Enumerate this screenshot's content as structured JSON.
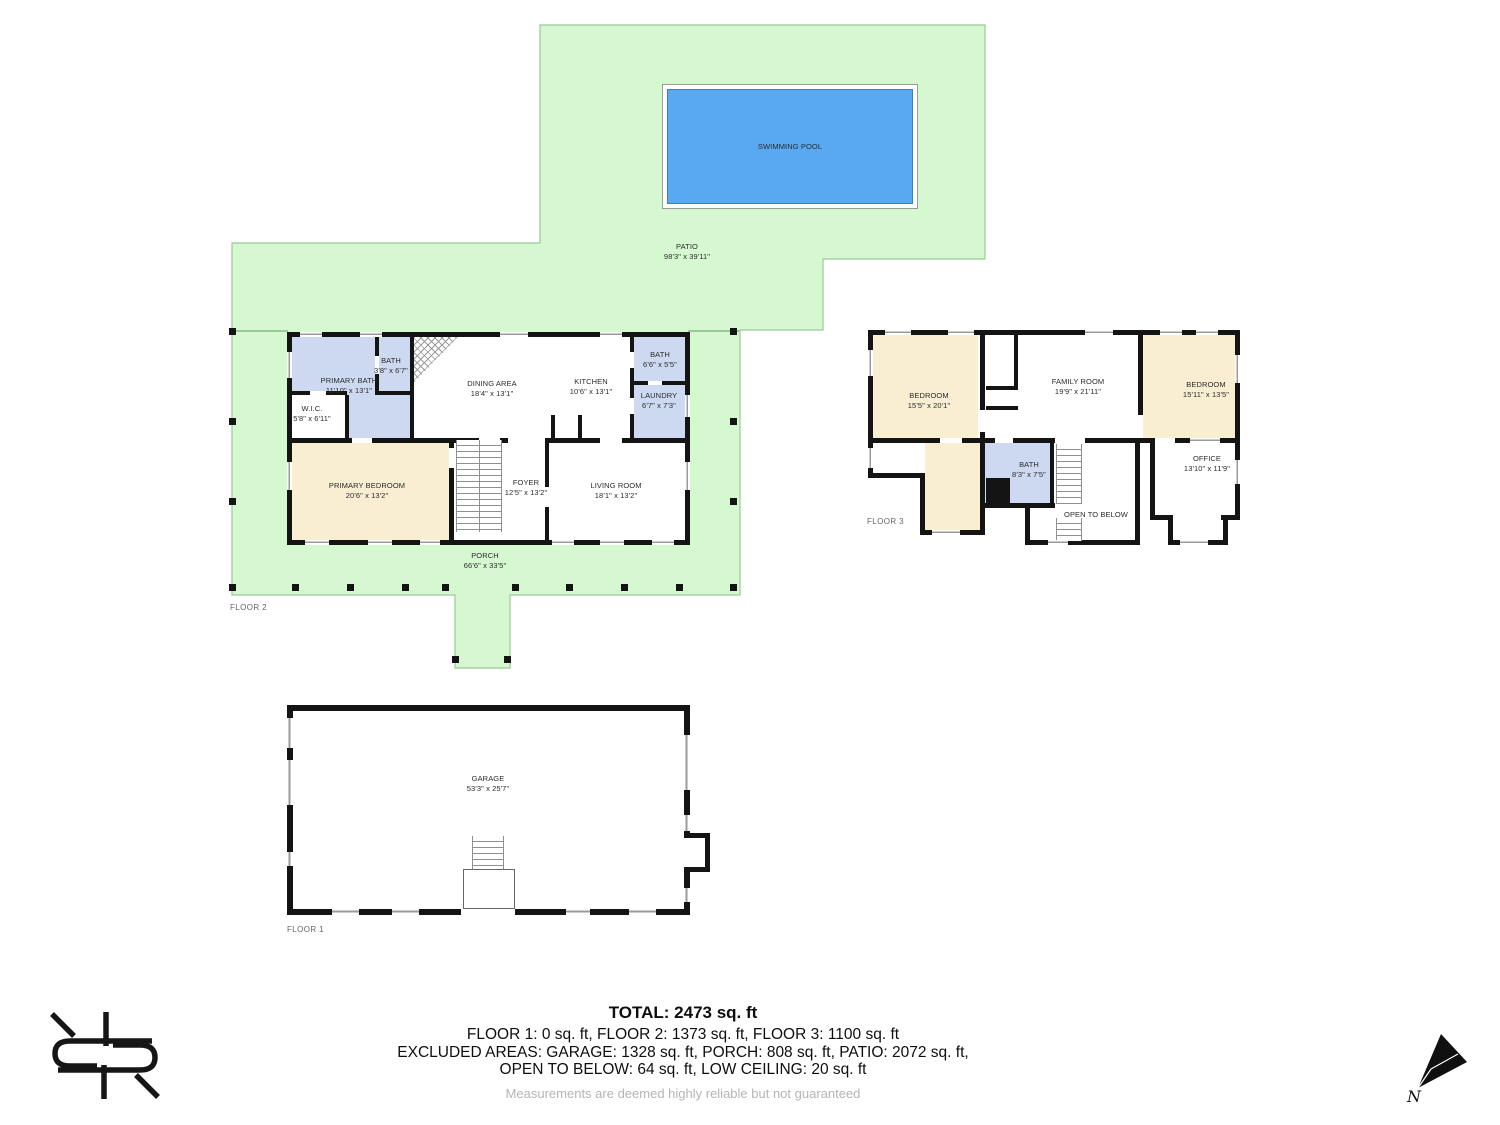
{
  "site": {
    "patio": {
      "name": "PATIO",
      "dims": "98'3\" x 39'11\""
    },
    "pool": {
      "name": "SWIMMING POOL"
    }
  },
  "floor2": {
    "label": "FLOOR 2",
    "rooms": {
      "primary_bath": {
        "name": "PRIMARY BATH",
        "dims": "11'10\" x 13'1\""
      },
      "bath_small": {
        "name": "BATH",
        "dims": "3'8\" x 6'7\""
      },
      "wic": {
        "name": "W.I.C.",
        "dims": "5'8\" x 6'11\""
      },
      "dining": {
        "name": "DINING AREA",
        "dims": "18'4\" x 13'1\""
      },
      "kitchen": {
        "name": "KITCHEN",
        "dims": "10'6\" x 13'1\""
      },
      "bath": {
        "name": "BATH",
        "dims": "6'6\" x 5'5\""
      },
      "laundry": {
        "name": "LAUNDRY",
        "dims": "6'7\" x 7'3\""
      },
      "primary_bedroom": {
        "name": "PRIMARY BEDROOM",
        "dims": "20'6\" x 13'2\""
      },
      "foyer": {
        "name": "FOYER",
        "dims": "12'5\" x 13'2\""
      },
      "living_room": {
        "name": "LIVING ROOM",
        "dims": "18'1\" x 13'2\""
      },
      "porch": {
        "name": "PORCH",
        "dims": "66'6\" x 33'5\""
      }
    }
  },
  "floor3": {
    "label": "FLOOR 3",
    "rooms": {
      "bedroom_left": {
        "name": "BEDROOM",
        "dims": "15'5\" x 20'1\""
      },
      "family_room": {
        "name": "FAMILY ROOM",
        "dims": "19'9\" x 21'11\""
      },
      "bedroom_right": {
        "name": "BEDROOM",
        "dims": "15'11\" x 13'5\""
      },
      "bath": {
        "name": "BATH",
        "dims": "8'3\" x 7'5\""
      },
      "office": {
        "name": "OFFICE",
        "dims": "13'10\" x 11'9\""
      },
      "open_to_below": {
        "name": "OPEN TO BELOW"
      }
    }
  },
  "floor1": {
    "label": "FLOOR 1",
    "rooms": {
      "garage": {
        "name": "GARAGE",
        "dims": "53'3\" x 25'7\""
      }
    }
  },
  "summary": {
    "total": "TOTAL: 2473 sq. ft",
    "line1": "FLOOR 1: 0 sq. ft, FLOOR 2: 1373 sq. ft, FLOOR 3: 1100 sq. ft",
    "line2": "EXCLUDED AREAS: GARAGE: 1328 sq. ft, PORCH: 808 sq. ft, PATIO: 2072 sq. ft,",
    "line3": "OPEN TO BELOW: 64 sq. ft, LOW CEILING: 20 sq. ft",
    "disclaimer": "Measurements are deemed highly reliable but not guaranteed"
  },
  "compass": {
    "north_label": "N"
  },
  "colors": {
    "outdoor_green": "#d5f8d0",
    "pool_blue": "#58a9f1",
    "bath_blue": "#ccd9f1",
    "bedroom_cream": "#f9edd2",
    "wall_black": "#141414"
  }
}
